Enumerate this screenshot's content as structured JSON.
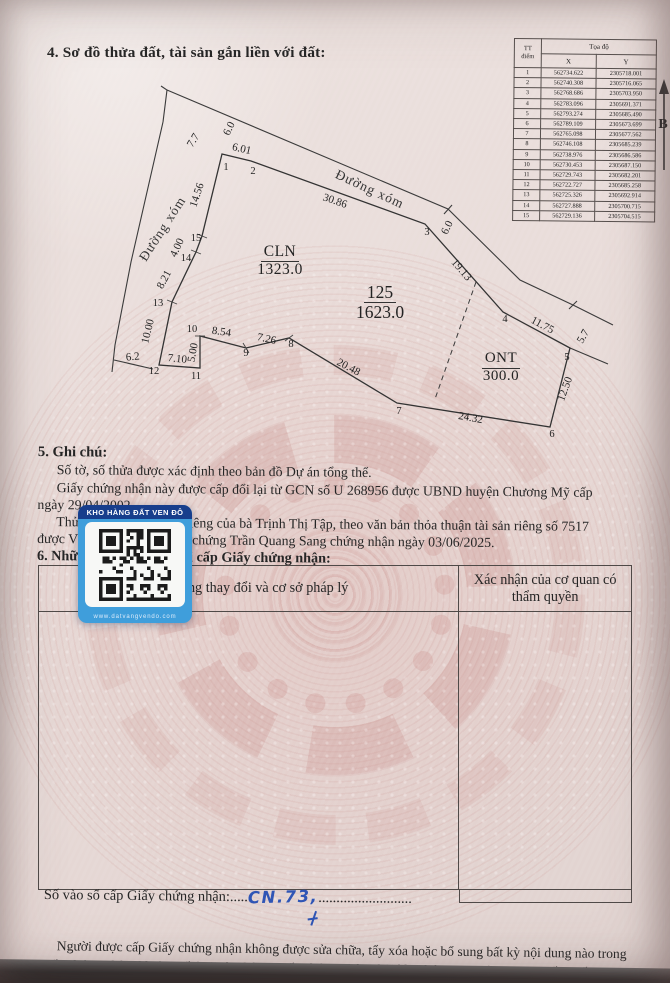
{
  "document": {
    "section4_title": "4. Sơ đồ thửa đất, tài sản gắn liền với đất:",
    "section5": {
      "title": "5. Ghi chú:",
      "line1": "Số tờ, số thửa được xác định theo bản đồ Dự án tổng thể.",
      "line2": "Giấy chứng nhận này được cấp đổi lại từ GCN số U 268956 được UBND huyện Chương Mỹ cấp",
      "line3": "ngày 29/04/2002",
      "line4": "Thửa đất này là tài sản riêng của bà Trịnh Thị Tập, theo văn bản thỏa thuận tài sản riêng số 7517",
      "line5_start": "được Văn phòng công",
      "line5_visible": "chứng Trần Quang Sang chứng nhận ngày 03/06/2025."
    },
    "section6": {
      "title": "6. Những thay đổi sau khi cấp Giấy chứng nhận:",
      "col1_header": "Nội dung thay đổi và cơ sở pháp lý",
      "col2_header": "Xác nhận của cơ quan có thẩm quyền"
    },
    "footer": {
      "entry_label": "Số vào sổ cấp Giấy chứng nhận:",
      "leader_dots_pre": ".....",
      "handwritten_number": "CN.73,",
      "leader_dots_post": "..........................",
      "note_line1": "Người được cấp Giấy chứng nhận không được sửa chữa, tẩy xóa hoặc bổ sung bất kỳ nội dung nào trong",
      "note_line2": "Giấy chứng nhận; khi bị mất hoặc hư hỏng Giấy chứng nhận phải khai báo ngay với cơ quan cấp Giấy."
    }
  },
  "coord_table": {
    "header": {
      "tt_line1": "TT",
      "tt_line2": "điểm",
      "group": "Tọa độ",
      "x": "X",
      "y": "Y"
    },
    "rows": [
      {
        "tt": "1",
        "x": "562734.622",
        "y": "2305718.001"
      },
      {
        "tt": "2",
        "x": "562740.308",
        "y": "2305716.065"
      },
      {
        "tt": "3",
        "x": "562768.686",
        "y": "2305703.950"
      },
      {
        "tt": "4",
        "x": "562783.096",
        "y": "2305691.371"
      },
      {
        "tt": "5",
        "x": "562793.274",
        "y": "2305685.490"
      },
      {
        "tt": "6",
        "x": "562789.109",
        "y": "2305673.699"
      },
      {
        "tt": "7",
        "x": "562765.098",
        "y": "2305677.562"
      },
      {
        "tt": "8",
        "x": "562746.108",
        "y": "2305685.239"
      },
      {
        "tt": "9",
        "x": "562738.976",
        "y": "2305686.586"
      },
      {
        "tt": "10",
        "x": "562730.453",
        "y": "2305687.150"
      },
      {
        "tt": "11",
        "x": "562729.743",
        "y": "2305682.201"
      },
      {
        "tt": "12",
        "x": "562722.727",
        "y": "2305685.258"
      },
      {
        "tt": "13",
        "x": "562725.326",
        "y": "2305692.914"
      },
      {
        "tt": "14",
        "x": "562727.888",
        "y": "2305700.715"
      },
      {
        "tt": "15",
        "x": "562729.136",
        "y": "2305704.515"
      }
    ]
  },
  "diagram": {
    "zones": {
      "cln_code": "CLN",
      "cln_area": "1323.0",
      "plot_number": "125",
      "plot_area": "1623.0",
      "ont_code": "ONT",
      "ont_area": "300.0"
    },
    "labels": [
      {
        "t": "Đường xóm",
        "x": 166,
        "y": 231,
        "r": -57,
        "c": "road"
      },
      {
        "t": "Đường xóm",
        "x": 368,
        "y": 193,
        "r": 25,
        "c": "road"
      },
      {
        "t": "7.7",
        "x": 196,
        "y": 142,
        "r": -58,
        "c": "m"
      },
      {
        "t": "6.0",
        "x": 232,
        "y": 130,
        "r": -64,
        "c": "m"
      },
      {
        "t": "6.01",
        "x": 241,
        "y": 152,
        "r": 13,
        "c": "m"
      },
      {
        "t": "30.86",
        "x": 334,
        "y": 204,
        "r": 19,
        "c": "m"
      },
      {
        "t": "6.0",
        "x": 450,
        "y": 229,
        "r": -64,
        "c": "m"
      },
      {
        "t": "19.13",
        "x": 459,
        "y": 272,
        "r": 49,
        "c": "m"
      },
      {
        "t": "11.75",
        "x": 541,
        "y": 328,
        "r": 28,
        "c": "m"
      },
      {
        "t": "5.7",
        "x": 586,
        "y": 338,
        "r": -60,
        "c": "m"
      },
      {
        "t": "12.50",
        "x": 568,
        "y": 390,
        "r": -70,
        "c": "m"
      },
      {
        "t": "24.32",
        "x": 470,
        "y": 421,
        "r": 10,
        "c": "m"
      },
      {
        "t": "20.48",
        "x": 347,
        "y": 370,
        "r": 28,
        "c": "m"
      },
      {
        "t": "7.26",
        "x": 266,
        "y": 342,
        "r": 12,
        "c": "m"
      },
      {
        "t": "8.54",
        "x": 221,
        "y": 335,
        "r": 8,
        "c": "m"
      },
      {
        "t": "5.00",
        "x": 196,
        "y": 353,
        "r": -80,
        "c": "m"
      },
      {
        "t": "7.10",
        "x": 177,
        "y": 362,
        "r": 6,
        "c": "m"
      },
      {
        "t": "6.2",
        "x": 133,
        "y": 360,
        "r": -5,
        "c": "m"
      },
      {
        "t": "10.00",
        "x": 151,
        "y": 332,
        "r": -76,
        "c": "m"
      },
      {
        "t": "8.21",
        "x": 167,
        "y": 281,
        "r": -62,
        "c": "m"
      },
      {
        "t": "4.00",
        "x": 180,
        "y": 249,
        "r": -65,
        "c": "m"
      },
      {
        "t": "14.56",
        "x": 200,
        "y": 196,
        "r": -72,
        "c": "m"
      },
      {
        "t": "B",
        "x": 663,
        "y": 128,
        "r": 0,
        "c": "north"
      }
    ],
    "points": [
      {
        "n": "1",
        "x": 226,
        "y": 170
      },
      {
        "n": "2",
        "x": 253,
        "y": 174
      },
      {
        "n": "3",
        "x": 427,
        "y": 235
      },
      {
        "n": "4",
        "x": 505,
        "y": 322
      },
      {
        "n": "5",
        "x": 567,
        "y": 360
      },
      {
        "n": "6",
        "x": 552,
        "y": 437
      },
      {
        "n": "7",
        "x": 399,
        "y": 414
      },
      {
        "n": "8",
        "x": 291,
        "y": 347
      },
      {
        "n": "9",
        "x": 246,
        "y": 356
      },
      {
        "n": "10",
        "x": 192,
        "y": 332
      },
      {
        "n": "11",
        "x": 196,
        "y": 379
      },
      {
        "n": "12",
        "x": 154,
        "y": 374
      },
      {
        "n": "13",
        "x": 158,
        "y": 306
      },
      {
        "n": "14",
        "x": 186,
        "y": 261
      },
      {
        "n": "15",
        "x": 196,
        "y": 241
      }
    ]
  },
  "qr_card": {
    "banner": "KHO HÀNG ĐẤT VEN ĐÔ",
    "url": "www.datvangvendo.com"
  }
}
